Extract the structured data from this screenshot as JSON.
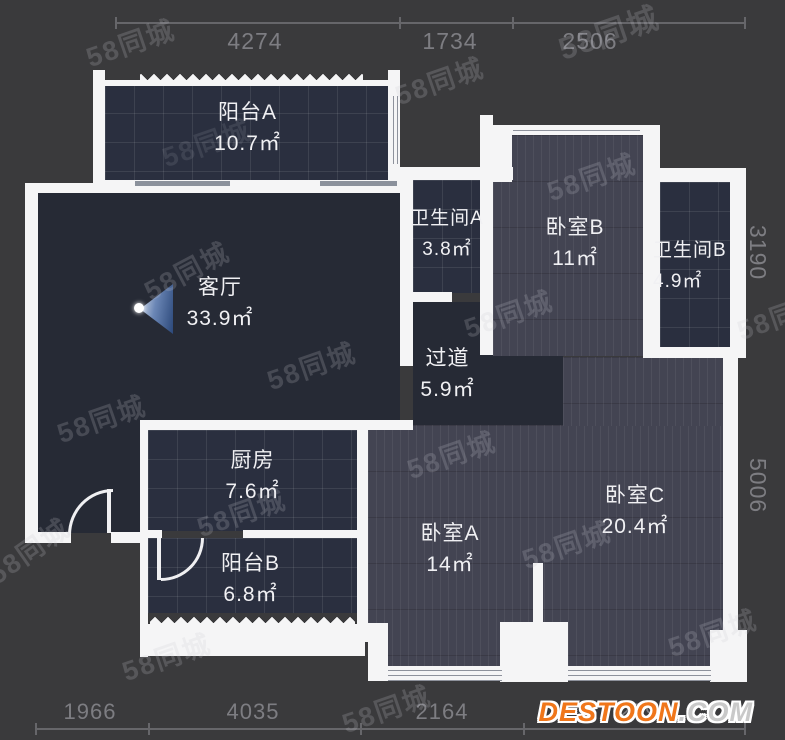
{
  "watermark": {
    "text": "58同城"
  },
  "logo": {
    "name": "DESTOON",
    "tld": ".COM"
  },
  "rooms": {
    "balcony_a": {
      "name": "阳台A",
      "area": "10.7㎡"
    },
    "living": {
      "name": "客厅",
      "area": "33.9㎡"
    },
    "bath_a": {
      "name": "卫生间A",
      "area": "3.8㎡"
    },
    "bed_b": {
      "name": "卧室B",
      "area": "11㎡"
    },
    "bath_b": {
      "name": "卫生间B",
      "area": "4.9㎡"
    },
    "hallway": {
      "name": "过道",
      "area": "5.9㎡"
    },
    "kitchen": {
      "name": "厨房",
      "area": "7.6㎡"
    },
    "balcony_b": {
      "name": "阳台B",
      "area": "6.8㎡"
    },
    "bed_a": {
      "name": "卧室A",
      "area": "14㎡"
    },
    "bed_c": {
      "name": "卧室C",
      "area": "20.4㎡"
    }
  },
  "dims": {
    "top": [
      "4274",
      "1734",
      "2506"
    ],
    "right": [
      "3190",
      "5006"
    ],
    "bottom": [
      "1966",
      "4035",
      "2164",
      "2794"
    ]
  },
  "colors": {
    "background": "#3A3A3C",
    "wall": "#F5F5F6",
    "floor_dark": "#262A35",
    "floor_tile": "#2A2F3F",
    "floor_wood": "#434452",
    "dim_text": "#7D7D82",
    "logo_orange": "#F0761A"
  }
}
